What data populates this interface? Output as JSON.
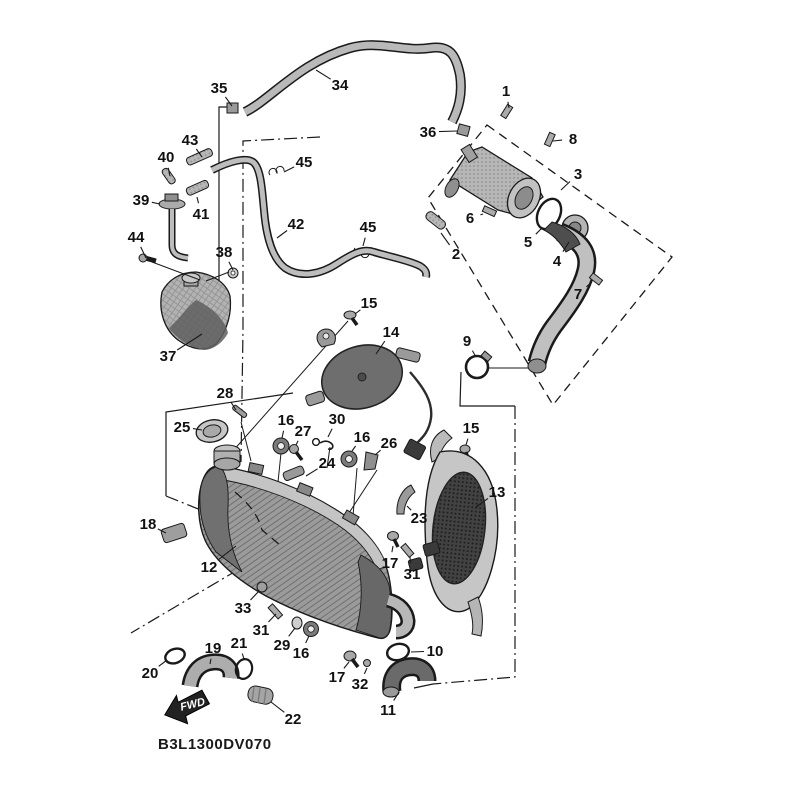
{
  "diagram": {
    "part_code": "B3L1300DV070",
    "fwd_label": "FWD",
    "colors": {
      "background": "#ffffff",
      "line": "#1a1a1a",
      "part_light": "#c6c6c6",
      "part_mid": "#999999",
      "part_dark": "#5f5f5f",
      "mesh_dark": "#3c3c3c"
    },
    "callouts": [
      {
        "label": "35",
        "x": 219,
        "y": 88,
        "tx": 232,
        "ty": 106
      },
      {
        "label": "34",
        "x": 340,
        "y": 85,
        "tx": 316,
        "ty": 70
      },
      {
        "label": "1",
        "x": 506,
        "y": 91,
        "tx": 509,
        "ty": 108
      },
      {
        "label": "36",
        "x": 428,
        "y": 132,
        "tx": 457,
        "ty": 131
      },
      {
        "label": "8",
        "x": 573,
        "y": 139,
        "tx": 553,
        "ty": 141
      },
      {
        "label": "3",
        "x": 578,
        "y": 174,
        "tx": 561,
        "ty": 190
      },
      {
        "label": "43",
        "x": 190,
        "y": 140,
        "tx": 202,
        "ty": 157
      },
      {
        "label": "40",
        "x": 166,
        "y": 157,
        "tx": 170,
        "ty": 176
      },
      {
        "label": "45",
        "x": 304,
        "y": 162,
        "tx": 284,
        "ty": 172
      },
      {
        "label": "39",
        "x": 141,
        "y": 200,
        "tx": 160,
        "ty": 204
      },
      {
        "label": "41",
        "x": 201,
        "y": 214,
        "tx": 197,
        "ty": 197
      },
      {
        "label": "44",
        "x": 136,
        "y": 237,
        "tx": 146,
        "ty": 258
      },
      {
        "label": "38",
        "x": 224,
        "y": 252,
        "tx": 233,
        "ty": 270
      },
      {
        "label": "42",
        "x": 296,
        "y": 224,
        "tx": 277,
        "ty": 238
      },
      {
        "label": "45",
        "x": 368,
        "y": 227,
        "tx": 363,
        "ty": 246
      },
      {
        "label": "6",
        "x": 470,
        "y": 218,
        "tx": 483,
        "ty": 214
      },
      {
        "label": "5",
        "x": 528,
        "y": 242,
        "tx": 542,
        "ty": 228
      },
      {
        "label": "2",
        "x": 456,
        "y": 254,
        "tx": 441,
        "ty": 233
      },
      {
        "label": "4",
        "x": 557,
        "y": 261,
        "tx": 569,
        "ty": 242
      },
      {
        "label": "7",
        "x": 578,
        "y": 294,
        "tx": 592,
        "ty": 282
      },
      {
        "label": "9",
        "x": 467,
        "y": 341,
        "tx": 476,
        "ty": 357
      },
      {
        "label": "15",
        "x": 369,
        "y": 303,
        "tx": 355,
        "ty": 314
      },
      {
        "label": "14",
        "x": 391,
        "y": 332,
        "tx": 376,
        "ty": 354
      },
      {
        "label": "37",
        "x": 168,
        "y": 356,
        "tx": 202,
        "ty": 334
      },
      {
        "label": "28",
        "x": 225,
        "y": 393,
        "tx": 236,
        "ty": 410
      },
      {
        "label": "25",
        "x": 182,
        "y": 427,
        "tx": 202,
        "ty": 430
      },
      {
        "label": "16",
        "x": 286,
        "y": 420,
        "tx": 282,
        "ty": 438
      },
      {
        "label": "27",
        "x": 303,
        "y": 431,
        "tx": 296,
        "ty": 445
      },
      {
        "label": "30",
        "x": 337,
        "y": 419,
        "tx": 328,
        "ty": 437
      },
      {
        "label": "16",
        "x": 362,
        "y": 437,
        "tx": 352,
        "ty": 451
      },
      {
        "label": "26",
        "x": 389,
        "y": 443,
        "tx": 375,
        "ty": 455
      },
      {
        "label": "24",
        "x": 327,
        "y": 463,
        "tx": 306,
        "ty": 476
      },
      {
        "label": "23",
        "x": 419,
        "y": 518,
        "tx": 407,
        "ty": 506
      },
      {
        "label": "15",
        "x": 471,
        "y": 428,
        "tx": 466,
        "ty": 445
      },
      {
        "label": "13",
        "x": 497,
        "y": 492,
        "tx": 476,
        "ty": 507
      },
      {
        "label": "18",
        "x": 148,
        "y": 524,
        "tx": 166,
        "ty": 533
      },
      {
        "label": "12",
        "x": 209,
        "y": 567,
        "tx": 236,
        "ty": 546
      },
      {
        "label": "33",
        "x": 243,
        "y": 608,
        "tx": 259,
        "ty": 591
      },
      {
        "label": "31",
        "x": 261,
        "y": 630,
        "tx": 276,
        "ty": 614
      },
      {
        "label": "29",
        "x": 282,
        "y": 645,
        "tx": 295,
        "ty": 628
      },
      {
        "label": "16",
        "x": 301,
        "y": 653,
        "tx": 309,
        "ty": 636
      },
      {
        "label": "17",
        "x": 337,
        "y": 677,
        "tx": 349,
        "ty": 662
      },
      {
        "label": "32",
        "x": 360,
        "y": 684,
        "tx": 367,
        "ty": 668
      },
      {
        "label": "10",
        "x": 435,
        "y": 651,
        "tx": 411,
        "ty": 652
      },
      {
        "label": "11",
        "x": 388,
        "y": 710,
        "tx": 399,
        "ty": 692
      },
      {
        "label": "22",
        "x": 293,
        "y": 719,
        "tx": 271,
        "ty": 702
      },
      {
        "label": "19",
        "x": 213,
        "y": 648,
        "tx": 210,
        "ty": 664
      },
      {
        "label": "21",
        "x": 239,
        "y": 643,
        "tx": 244,
        "ty": 659
      },
      {
        "label": "20",
        "x": 150,
        "y": 673,
        "tx": 167,
        "ty": 660
      },
      {
        "label": "17",
        "x": 390,
        "y": 563,
        "tx": 393,
        "ty": 546
      },
      {
        "label": "31",
        "x": 412,
        "y": 574,
        "tx": 410,
        "ty": 557
      }
    ]
  }
}
